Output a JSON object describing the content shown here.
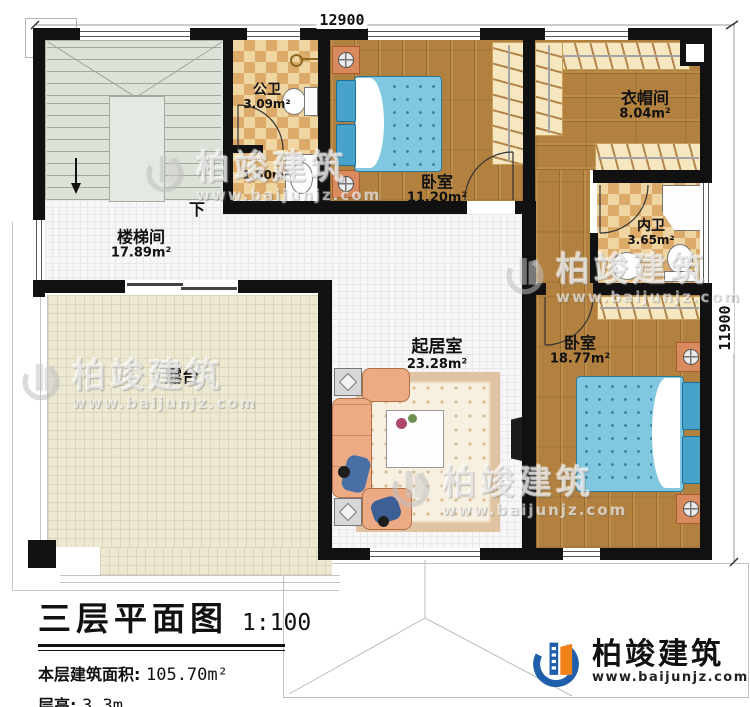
{
  "plan": {
    "title": "三层平面图",
    "scale": "1:100",
    "area_label": "本层建筑面积:",
    "area_value": "105.70m²",
    "floor_height_label": "层高:",
    "floor_height_value": "3.3m"
  },
  "dimensions": {
    "top": "12900",
    "right": "11900"
  },
  "rooms": [
    {
      "id": "stairwell",
      "name": "楼梯间",
      "area": "17.89m²"
    },
    {
      "id": "public-bath",
      "name": "公卫",
      "area": "3.09m²"
    },
    {
      "id": "washroom",
      "name": "",
      "area": "1.50m²"
    },
    {
      "id": "bedroom-1",
      "name": "卧室",
      "area": "11.20m²"
    },
    {
      "id": "cloakroom",
      "name": "衣帽间",
      "area": "8.04m²"
    },
    {
      "id": "private-bath",
      "name": "内卫",
      "area": "3.65m²"
    },
    {
      "id": "living-room",
      "name": "起居室",
      "area": "23.28m²"
    },
    {
      "id": "bedroom-2",
      "name": "卧室",
      "area": "18.77m²"
    },
    {
      "id": "terrace",
      "name": "露台",
      "area": ""
    }
  ],
  "annotations": {
    "stairs_down": "下"
  },
  "brand": {
    "name": "柏竣建筑",
    "url": "www.baijunjz.com"
  },
  "colors": {
    "wall": "#111111",
    "wood": "#b2813f",
    "bed": "#82c7e0",
    "logo_blue": "#1e5eaa",
    "logo_orange": "#f08018"
  }
}
